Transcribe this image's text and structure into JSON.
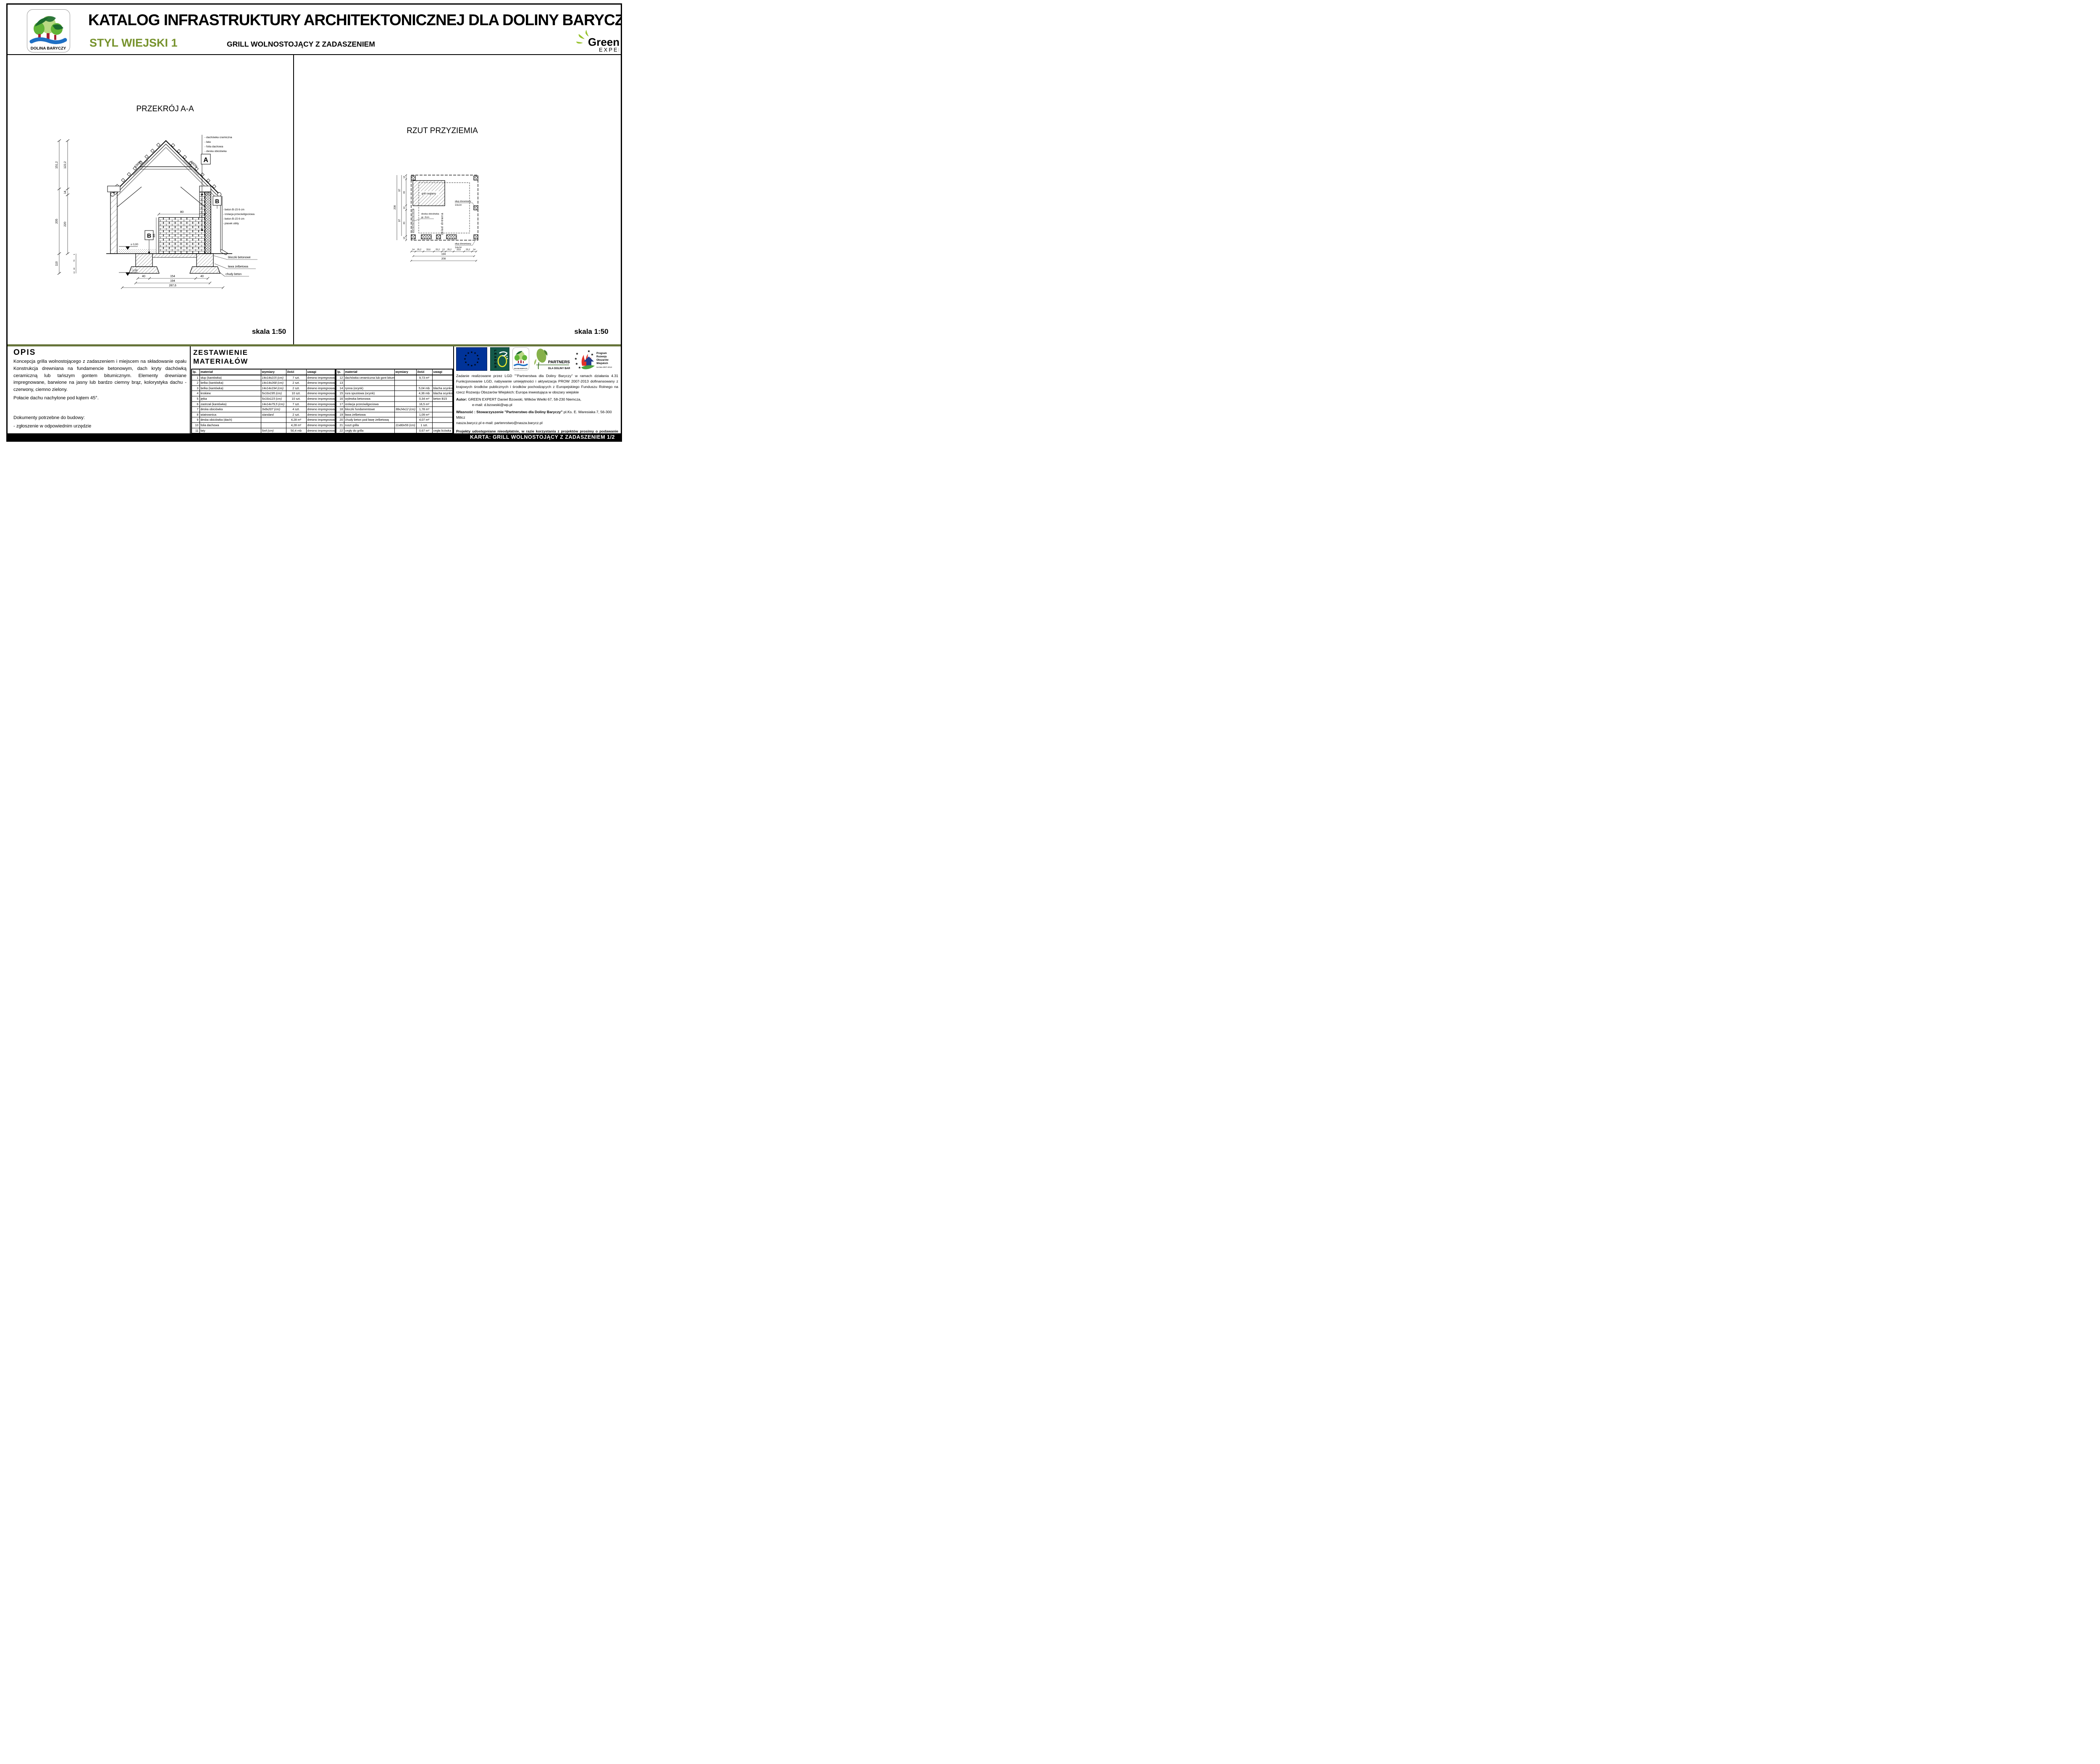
{
  "header": {
    "title": "KATALOG INFRASTRUKTURY ARCHITEKTONICZNEJ DLA DOLINY BARYCZY",
    "style_label": "STYL WIEJSKI 1",
    "subtitle": "GRILL WOLNOSTOJĄCY Z ZADASZENIEM",
    "logo_text": "DOLINA BARYCZY",
    "brand_green": "Green",
    "brand_expert": "EXPERT",
    "colors": {
      "style_green": "#76922c",
      "band_olive": "#66743a"
    }
  },
  "drawings": {
    "section": {
      "title": "PRZEKRÓJ A-A",
      "scale": "skala 1:50",
      "marker_a": "A",
      "marker_b": "B",
      "slope_left": "100%",
      "slope_right": "100%",
      "notes_a": [
        "- dachówka cramiczna",
        "- łata",
        "- folia dachowa",
        "- deska obiciówka"
      ],
      "notes_b": [
        "- beton B-15  6 cm",
        "- izolacja przeciwilgociowa",
        "- beton B-15  6 cm",
        "- piasek ubity"
      ],
      "labels": {
        "bloczki": "bloczki betonowe",
        "lawa": "ława żelbetowa",
        "chudy": "chudy beton"
      },
      "levels": {
        "zero": "± 0,00",
        "minus": "- 1,00"
      },
      "dims": {
        "left_outer": [
          "151,2",
          "205",
          "110"
        ],
        "left_inner": [
          "122,2",
          "14",
          "220"
        ],
        "left_below": [
          "5",
          "70",
          "30",
          "10"
        ],
        "grill_w": "80",
        "grill_h": "85",
        "wall": "14",
        "bottom": [
          "40",
          "154",
          "40"
        ],
        "total_194": "194",
        "total_287": "287,6"
      }
    },
    "plan": {
      "title": "RZUT PRZYZIEMIA",
      "scale": "skala 1:50",
      "labels": {
        "grill": "grill ceglany",
        "slup1a": "słup drewniany",
        "slup1b": "14x14",
        "slup2a": "słup drewniany",
        "slup2b": "14x14",
        "deska1": "deska obiciówka",
        "deska2": "gr. 2cm",
        "sklad": "skład drewna"
      },
      "dims": {
        "bottom": [
          "14",
          "25,2",
          "33,6",
          "25,2",
          "12",
          "25,2",
          "33,6",
          "25,2",
          "14"
        ],
        "total_194": "194",
        "total_208": "208",
        "left": [
          "14",
          "83",
          "14",
          "83",
          "14"
        ],
        "left_mid": [
          "97",
          "97"
        ],
        "left_total": "208"
      }
    }
  },
  "opis": {
    "heading": "OPIS",
    "para1": "Koncepcja grilla wolnostojącego z zadaszeniem i miejscem na składowanie opału Konstrukcja drewniana na fundamencie betonowym, dach kryty dachówką ceramiczną lub tańszym gontem bitumicznym. Elementy drewniane impregnowane, barwione na jasny lub bardzo ciemny brąz, kolorystyka dachu - czerwony, ciemno zielony.",
    "para2": "Połacie dachu nachylone pod kątem 45°.",
    "para3": "Dokumenty potrzebne do budowy:",
    "para4": "- zgłoszenie w odpowiednim urzędzie"
  },
  "materials": {
    "heading_line1": "ZESTAWIENIE",
    "heading_line2": "MATERIAŁÓW",
    "columns": [
      "lp.",
      "materiał",
      "wymiary",
      "ilość",
      "uwagi"
    ],
    "left_rows": [
      [
        "1",
        "słup (kantówka)",
        "14x14x215 (cm)",
        "7 szt.",
        "drewno impregnowane"
      ],
      [
        "2",
        "belka (kantówka)",
        "14x14x268 (cm)",
        "2 szt.",
        "drewno impregnowane"
      ],
      [
        "3",
        "belka (kantówka)",
        "14x14x194 (cm)",
        "2 szt.",
        "drewno impregnowane"
      ],
      [
        "4",
        "krokiew",
        "5x16x195 (cm)",
        "10 szt.",
        "drewno impregnowane"
      ],
      [
        "5",
        "jętka",
        "5x16x123 (cm)",
        "10 szt.",
        "drewno impregnowane"
      ],
      [
        "6",
        "zastrzał (kantówka)",
        "14x14x79,5 (cm)",
        "7 szt.",
        "drewno impregnowane"
      ],
      [
        "7",
        "deska obiciówka",
        "3x8x207 (cm)",
        "4 szt.",
        "drewno impregnowane"
      ],
      [
        "8",
        "wiatrownica",
        "standard",
        "2 szt.",
        "drewno impregnowane"
      ],
      [
        "9",
        "deska obiciówka (dach)",
        "",
        "4,28 m²",
        "drewno impregnowane"
      ],
      [
        "10",
        "folia dachowa",
        "",
        "4,28 m²",
        "drewno impregnowane"
      ],
      [
        "11",
        "łaty",
        "5x4 (cm)",
        "50,4 mb",
        "drewno impregnowane"
      ]
    ],
    "right_rows": [
      [
        "12",
        "dachówka ceramiczna lub gont bitumiczny",
        "",
        "9,73 m²",
        ""
      ],
      [
        "13",
        "",
        "",
        "",
        ""
      ],
      [
        "14",
        "rynna (ocynk)",
        "",
        "5,04 mb",
        "blacha ocynkowana"
      ],
      [
        "15",
        "rura spustowa (ocynk)",
        "",
        "4,36 mb",
        "blacha ocynkowana"
      ],
      [
        "16",
        "wylewka betonowa",
        "",
        "0,34 m³",
        "beton B15"
      ],
      [
        "17",
        "izolacja przeciwilgociowa",
        "",
        "16,5 m²",
        ""
      ],
      [
        "18",
        "bloczki fundamentowe",
        "38x24x12 (cm)",
        "1,78 m³",
        ""
      ],
      [
        "19",
        "ława żelbetowa",
        "",
        "1,09 m³",
        ""
      ],
      [
        "20",
        "chudy beton pod ławę żelbetową",
        "",
        "4,07 m²",
        ""
      ],
      [
        "21",
        "ruszt grilla",
        "11x80x59 (cm)",
        "1 szt.",
        ""
      ],
      [
        "22",
        "cegły do grilla",
        "",
        "0,67 m³",
        "cegła licówka"
      ]
    ]
  },
  "logos": {
    "leader_text": "LEADER",
    "dolina_text": "DOLINA BARYCZY",
    "partner_line1": "PARTNERSTWO",
    "partner_line2": "DLA DOLINY BARYCZY",
    "prow_l1": "Program",
    "prow_l2": "Rozwoju",
    "prow_l3": "Obszarów",
    "prow_l4": "Wiejskich",
    "prow_years": "na lata 2007-2013",
    "colors": {
      "eu_blue": "#003399",
      "eu_star": "#ffcc00",
      "leader_green": "#14594a",
      "leader_yellow": "#efe92e",
      "partner_green": "#2f5d1f",
      "partner_leaf": "#86b14a",
      "prow_blue": "#233e8f",
      "prow_red": "#e23127",
      "prow_green": "#4da23f"
    }
  },
  "info": {
    "zadanie": "Zadanie realizowane przez LGD \"\"Partnerstwa dla Doliny Baryczy\" w ramach działania 4.31 Funkcjonowanie LGD, nabywanie umiejętności i aktywizacja PROW 2007-2013 dofinansowany z krajowych środków publicznych i środków pochodzących z Europejskiego Funduszu Rolnego na rzecz Rozwoju Obszarów Wiejskich: Europa inwestująca w obszary wiejskie",
    "autor_label": "Autor:",
    "autor": "GREEN EXPERT Daniel Bzowski, Wilków Wielki 67, 58-230 Niemcza,",
    "email": "e-mail: d.bzowski@wp.pl",
    "wlasnosc_label": "Własność : Stowarzyszenie \"Partnerstwo dla Doliny Baryczy\"",
    "wlasnosc_rest": " pl.Ks. E. Waresiaka 7, 56-300 Milicz",
    "web": "nasza.barycz.pl  e-mail:  partenrstwo@nasza.barycz.pl",
    "disclaimer": "Projekty udostępniane nieodpłatnie, w razie korzystania z projektów prosimy o podawanie informacji o właścicielu. Wszelkie zmiany i modyfikacje projektów ponoszone są na koszt własny, za zgoda właściciela i autora opracowania."
  },
  "footer": {
    "text": "KARTA: GRILL WOLNOSTOJĄCY Z ZADASZENIEM 1/2"
  }
}
